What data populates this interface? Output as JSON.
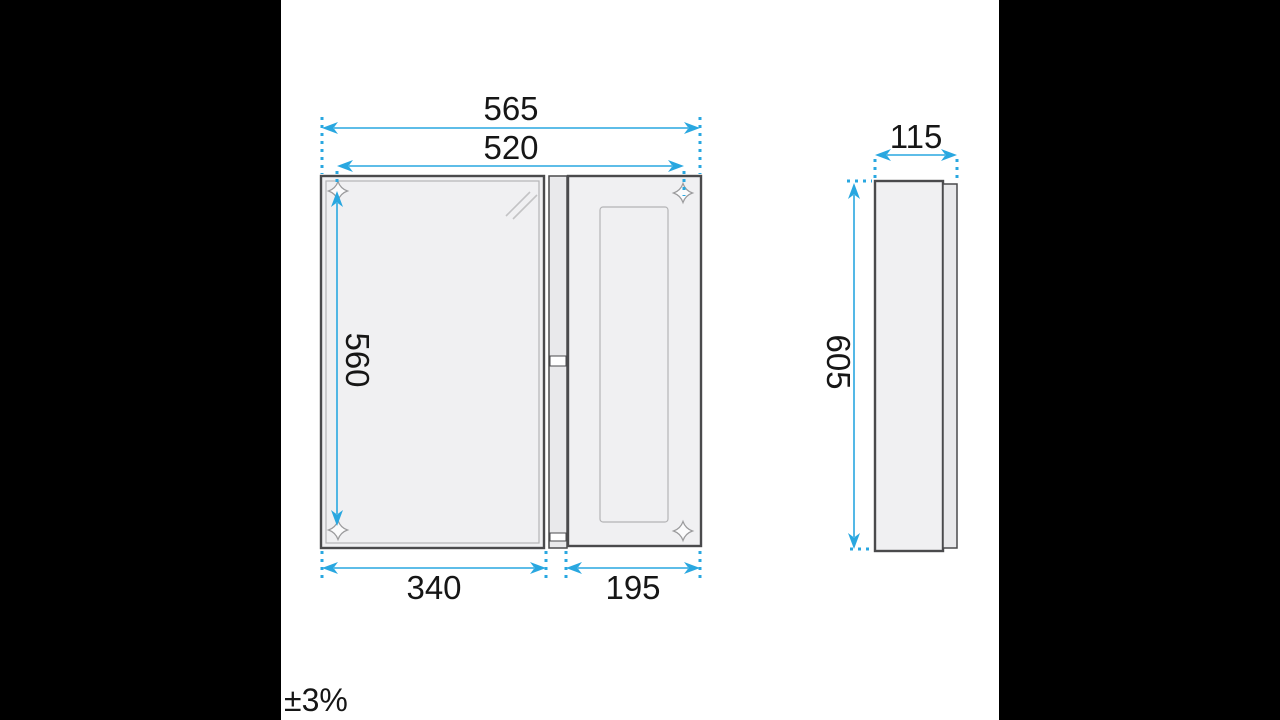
{
  "drawing": {
    "front_view": {
      "dimensions": {
        "overall_width": "565",
        "hole_spacing_width": "520",
        "hole_spacing_height": "560",
        "mirror_door_width": "340",
        "side_cabinet_width": "195"
      }
    },
    "side_view": {
      "dimensions": {
        "depth": "115",
        "height": "605"
      }
    },
    "tolerance": "±3%",
    "icons": {
      "mounting_hole": "mounting-hole-icon",
      "glass_reflection": "glass-reflection-icon"
    },
    "colors": {
      "dimension_line": "#29a7e0",
      "outline": "#4a4a4c",
      "panel_fill": "#f0f0f2",
      "background": "#ffffff",
      "letterbox": "#000000"
    }
  }
}
